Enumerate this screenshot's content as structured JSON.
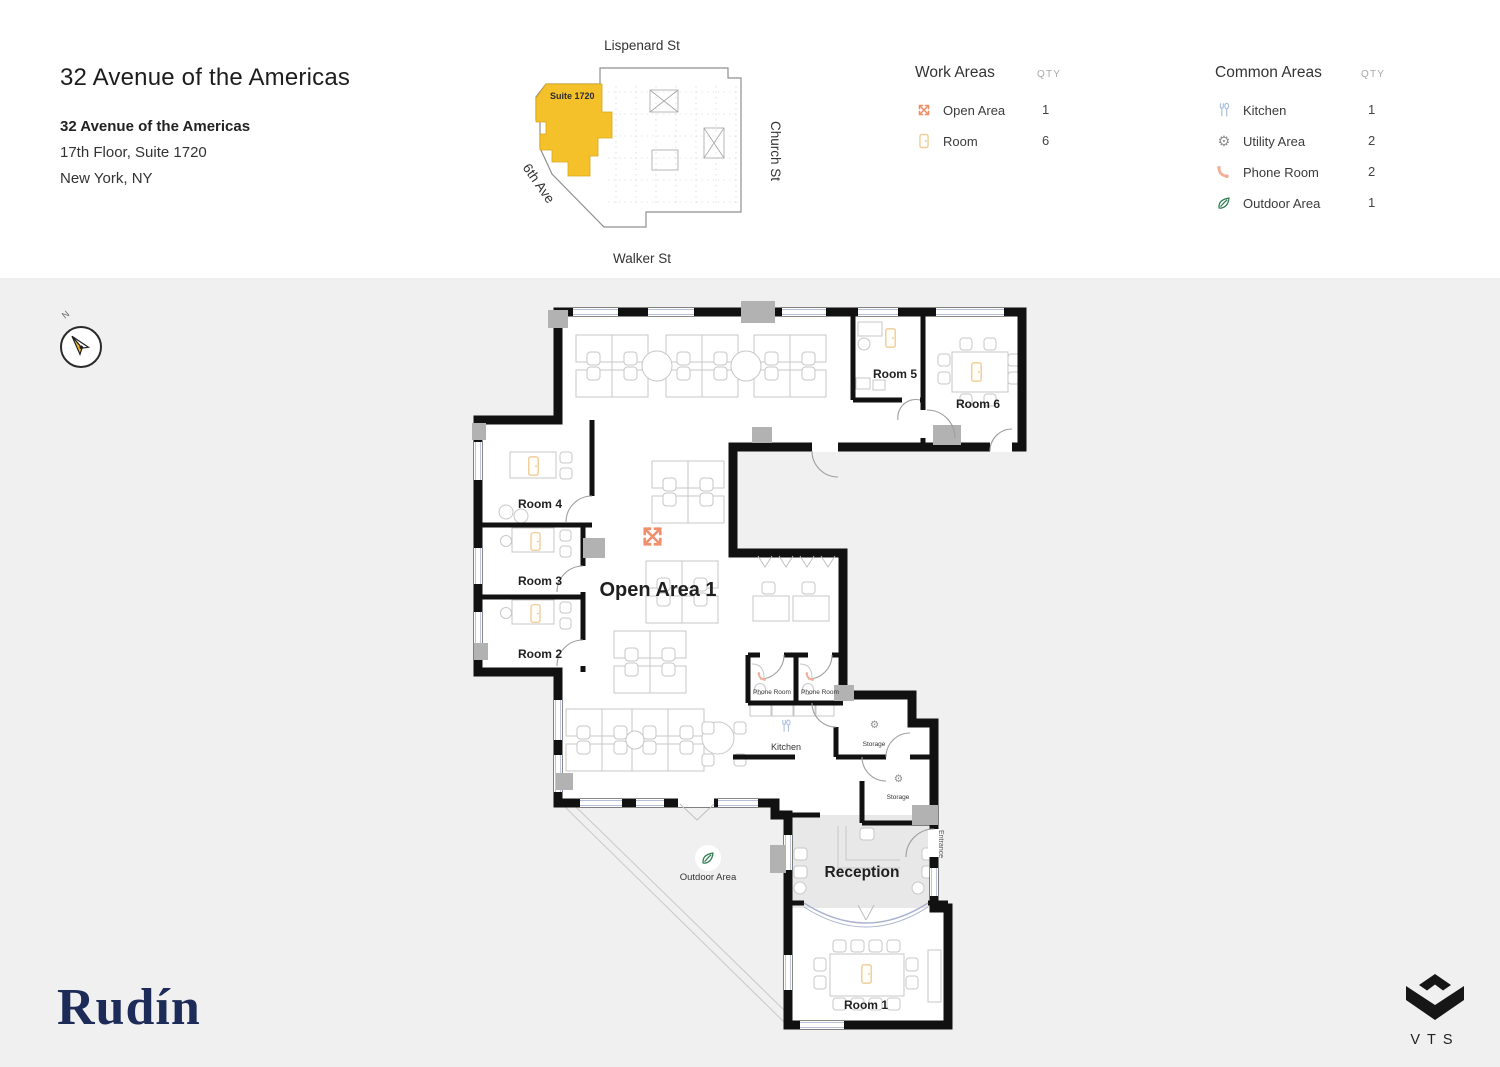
{
  "header": {
    "title": "32 Avenue of the Americas",
    "building_name": "32 Avenue of the Americas",
    "floor_suite": "17th Floor, Suite 1720",
    "city": "New York, NY"
  },
  "mini_map": {
    "street_top": "Lispenard St",
    "street_right": "Church St",
    "street_bottom": "Walker St",
    "street_left": "6th Ave",
    "suite_label": "Suite 1720",
    "highlight_color": "#F5C12B"
  },
  "legend": {
    "work_areas": {
      "title": "Work Areas",
      "qty_header": "QTY",
      "items": [
        {
          "label": "Open Area",
          "qty": "1",
          "icon": "open-area-icon"
        },
        {
          "label": "Room",
          "qty": "6",
          "icon": "room-icon"
        }
      ]
    },
    "common_areas": {
      "title": "Common Areas",
      "qty_header": "QTY",
      "items": [
        {
          "label": "Kitchen",
          "qty": "1",
          "icon": "kitchen-icon"
        },
        {
          "label": "Utility Area",
          "qty": "2",
          "icon": "utility-gear-icon"
        },
        {
          "label": "Phone Room",
          "qty": "2",
          "icon": "phone-icon"
        },
        {
          "label": "Outdoor Area",
          "qty": "1",
          "icon": "leaf-icon"
        }
      ]
    }
  },
  "plan": {
    "compass": "N",
    "open_area_label": "Open Area 1",
    "room_labels": {
      "room1": "Room 1",
      "room2": "Room 2",
      "room3": "Room 3",
      "room4": "Room 4",
      "room5": "Room 5",
      "room6": "Room 6"
    },
    "phone_room_label": "Phone Room",
    "kitchen_label": "Kitchen",
    "storage_label": "Storage",
    "reception_label": "Reception",
    "outdoor_label": "Outdoor Area",
    "entrance_label": "Entrance",
    "gear_glyph": "⚙"
  },
  "branding": {
    "owner_logo": "Rudín",
    "platform_logo": "VTS"
  },
  "colors": {
    "accent_orange": "#EF8F6C",
    "room_marker": "#F1CB94",
    "kitchen_blue": "#A9BEDD",
    "utility_gray": "#8F8F8F",
    "phone_salmon": "#F2AF97",
    "outdoor_green": "#2E7B51",
    "suite_highlight": "#F5C12B",
    "wall_black": "#111111",
    "canvas_gray": "#F0F0F1",
    "reception_fill": "#E8E8E8",
    "rudin_navy": "#1C2B58"
  }
}
